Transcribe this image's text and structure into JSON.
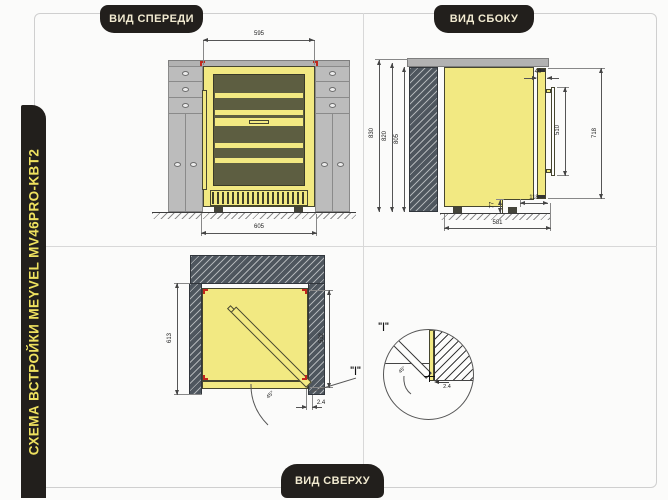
{
  "sidebar_title": "СХЕМА ВСТРОЙКИ MEYVEL MV46PRO-KBT2",
  "badges": {
    "front": "ВИД СПЕРЕДИ",
    "side": "ВИД СБОКУ",
    "top": "ВИД СВЕРХУ"
  },
  "front_view": {
    "dim_door_width": "595",
    "dim_niche_width": "605"
  },
  "side_view": {
    "dim_overall_height": "830",
    "dim_mid_height": "820",
    "dim_niche_height": "805",
    "dim_door_thickness": "40",
    "dim_handle_length": "510",
    "dim_door_height": "718",
    "dim_vent_height": "77",
    "dim_vent_depth": "118",
    "dim_depth": "581"
  },
  "top_view": {
    "dim_niche_depth": "613",
    "dim_body_depth": "532",
    "dim_gap": "2.4",
    "dim_angle": "45°",
    "detail_ref": "\"|\""
  },
  "detail_view": {
    "label": "\"|\"",
    "dim_gap": "2.4",
    "dim_angle": "45°"
  },
  "colors": {
    "accent_yellow": "#eee15f",
    "fridge_yellow": "#f2e982",
    "badge_black": "#221f1c",
    "glass_olive": "#5d5e41",
    "cabinet_gray": "#bcbcbc",
    "hatch_slate": "#4e565e",
    "mark_red": "#c2271c"
  }
}
